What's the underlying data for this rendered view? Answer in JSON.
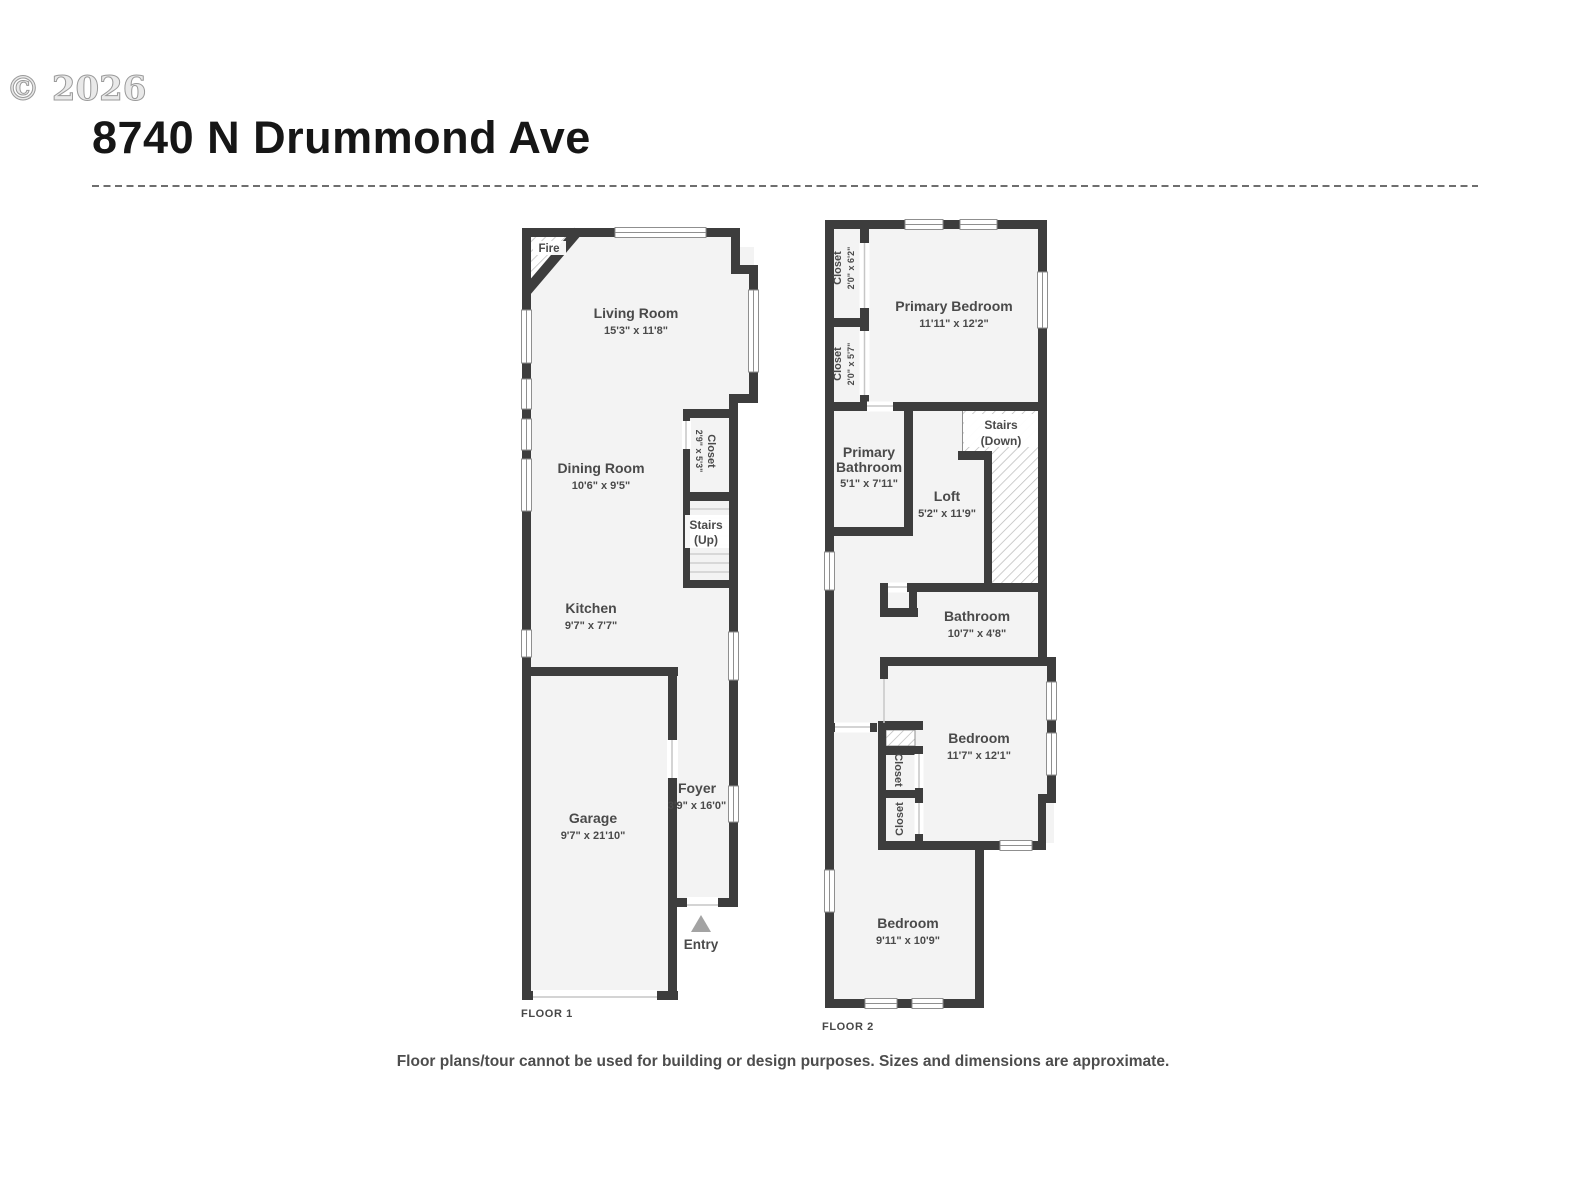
{
  "header": {
    "copyright": "© 2026",
    "title": "8740 N Drummond Ave"
  },
  "footer": {
    "disclaimer": "Floor plans/tour cannot be used for building or design purposes. Sizes and dimensions are approximate."
  },
  "colors": {
    "wall": "#3d3d3d",
    "room_fill": "#f3f3f3",
    "text": "#4a4a4a",
    "hatch_line": "#b8b8b8",
    "entry_arrow": "#a3a3a3"
  },
  "floor1": {
    "label": "FLOOR 1",
    "fire": "Fire",
    "entry": "Entry",
    "stairs": {
      "line1": "Stairs",
      "line2": "(Up)"
    },
    "living": {
      "name": "Living Room",
      "dims": "15'3\" x 11'8\""
    },
    "dining": {
      "name": "Dining Room",
      "dims": "10'6\" x 9'5\""
    },
    "kitchen": {
      "name": "Kitchen",
      "dims": "9'7\" x 7'7\""
    },
    "garage": {
      "name": "Garage",
      "dims": "9'7\" x 21'10\""
    },
    "foyer": {
      "name": "Foyer",
      "dims": "3'9\" x 16'0\""
    },
    "closet": {
      "name": "Closet",
      "dims": "2'9\" x 5'3\""
    }
  },
  "floor2": {
    "label": "FLOOR 2",
    "stairs": {
      "line1": "Stairs",
      "line2": "(Down)"
    },
    "primary_bedroom": {
      "name": "Primary Bedroom",
      "dims": "11'11\" x 12'2\""
    },
    "closet_a": {
      "name": "Closet",
      "dims": "2'0\" x 6'2\""
    },
    "closet_b": {
      "name": "Closet",
      "dims": "2'0\" x 5'7\""
    },
    "primary_bathroom": {
      "line1": "Primary",
      "line2": "Bathroom",
      "dims": "5'1\" x 7'11\""
    },
    "loft": {
      "name": "Loft",
      "dims": "5'2\" x 11'9\""
    },
    "bathroom": {
      "name": "Bathroom",
      "dims": "10'7\" x 4'8\""
    },
    "bedroom_mid": {
      "name": "Bedroom",
      "dims": "11'7\" x 12'1\""
    },
    "closet_c": "Closet",
    "closet_d": "Closet",
    "bedroom_bottom": {
      "name": "Bedroom",
      "dims": "9'11\" x 10'9\""
    }
  }
}
